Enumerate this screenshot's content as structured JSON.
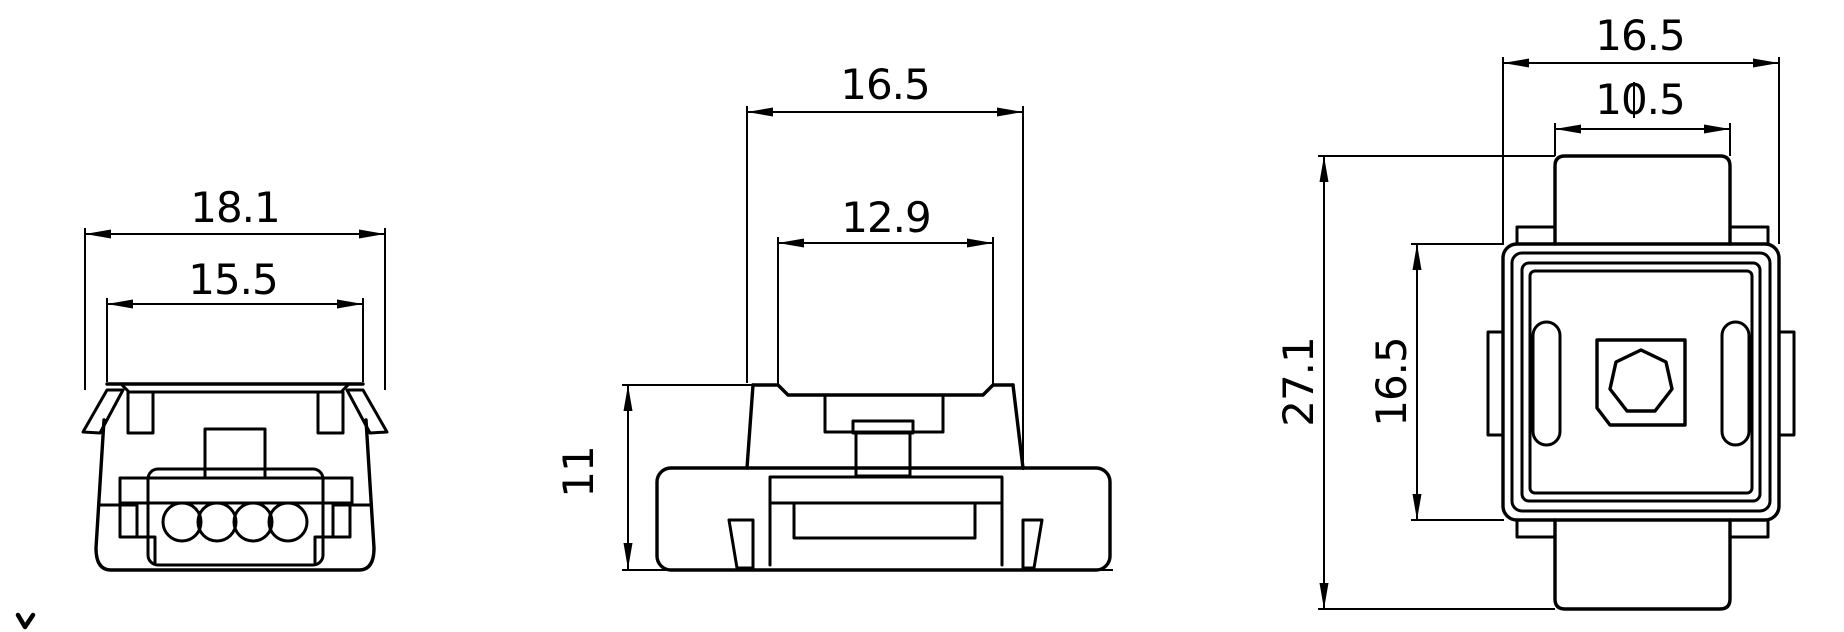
{
  "canvas": {
    "background_color": "#ffffff",
    "line_color": "#000000",
    "width": 1844,
    "height": 632
  },
  "dims": {
    "front_overall_width": "18.1",
    "front_top_width": "15.5",
    "side_width": "16.5",
    "side_recess_width": "12.9",
    "side_height": "11",
    "top_width": "16.5",
    "top_cap_width": "10.5",
    "top_overall_depth": "27.1",
    "top_body_depth": "16.5"
  },
  "icons": {
    "axis_marker": "chevron-mark"
  }
}
